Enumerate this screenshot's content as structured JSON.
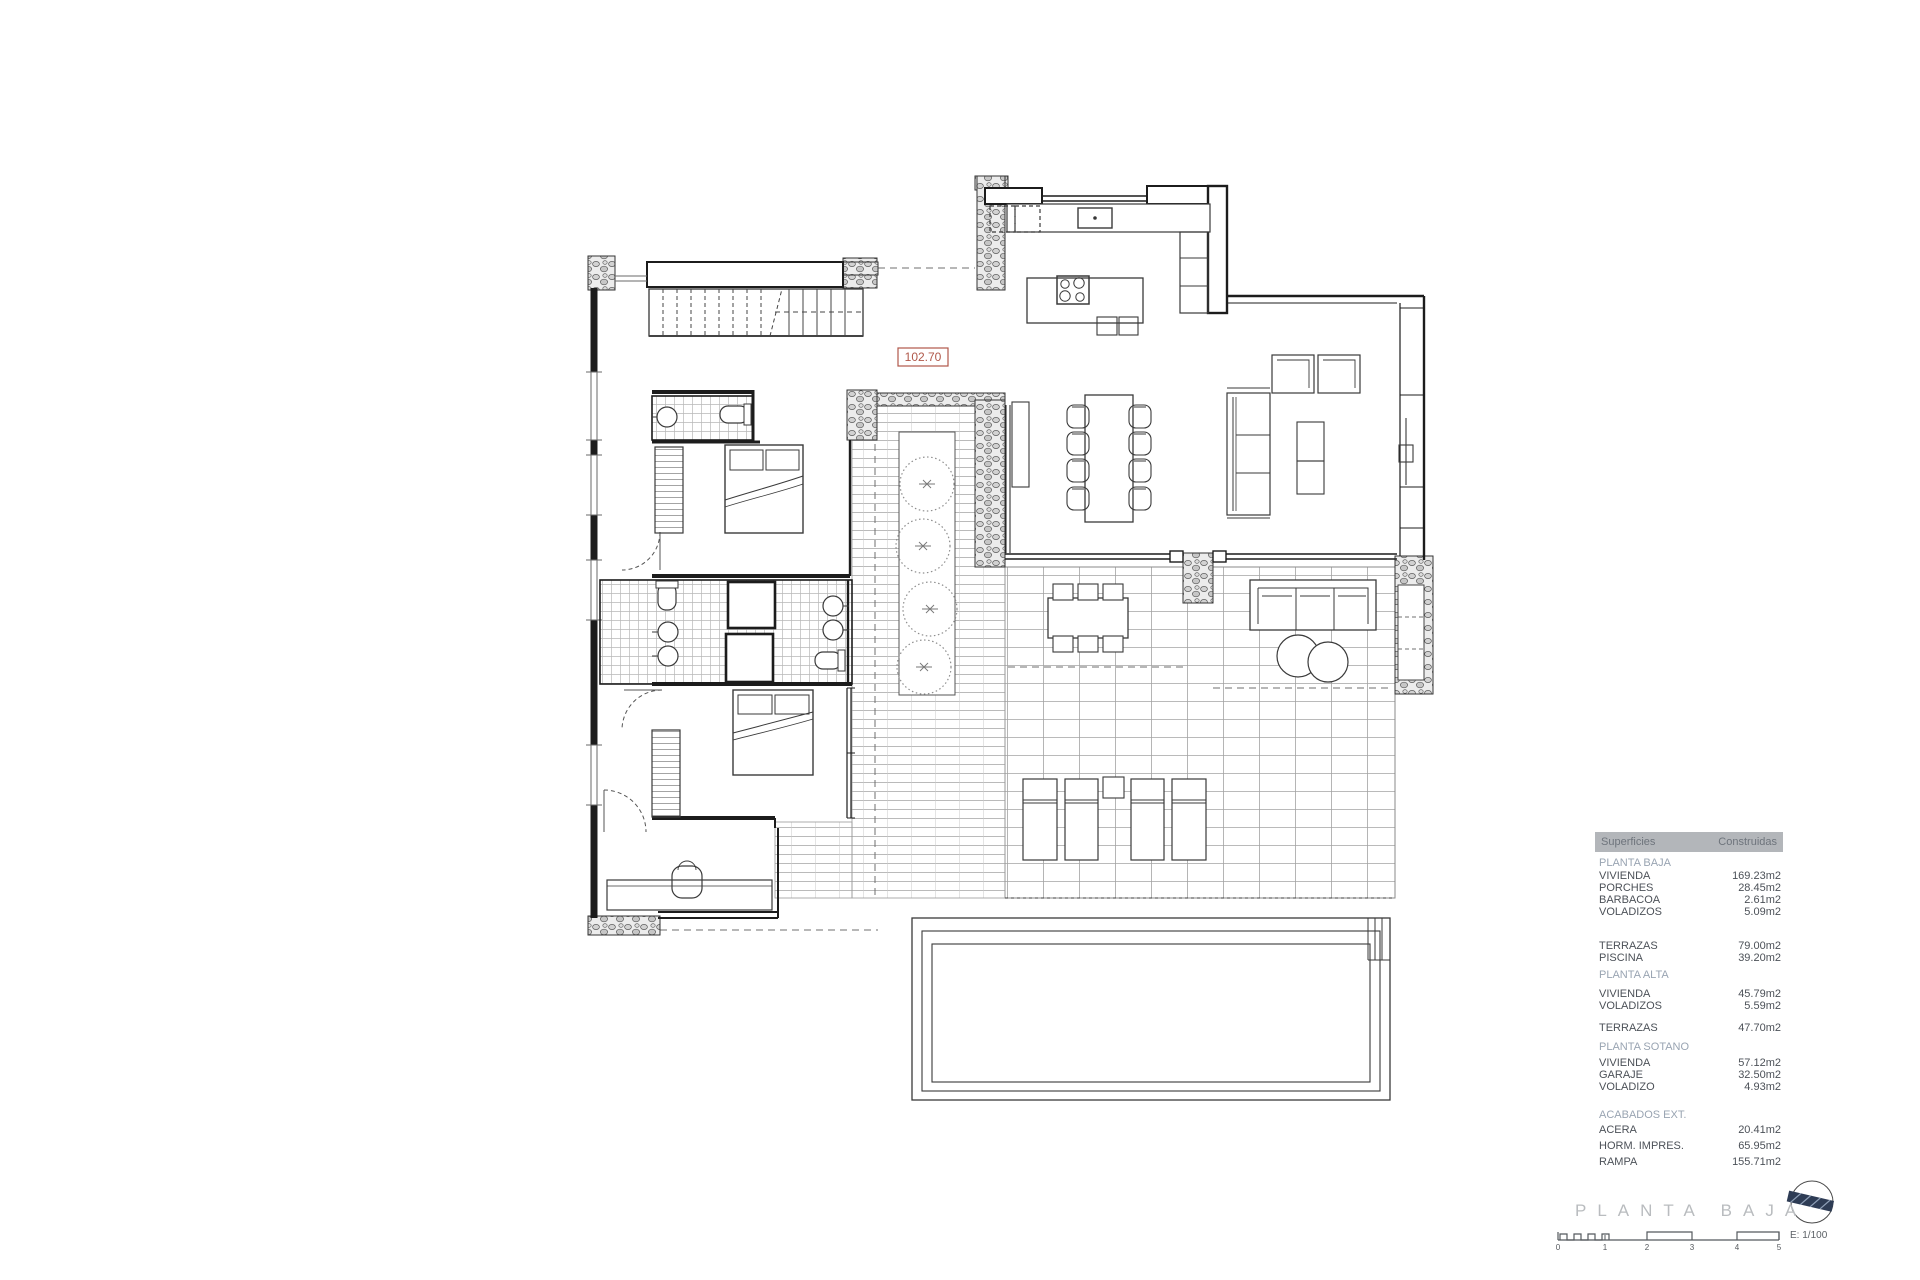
{
  "plan": {
    "red_label": "102.70",
    "title": "PLANTA BAJA",
    "scale_label": "E: 1/100",
    "scale_numbers": [
      "0",
      "1",
      "2",
      "3",
      "4",
      "5"
    ]
  },
  "table": {
    "header": {
      "col1": "Superficies",
      "col2": "Construidas"
    },
    "blocks": [
      {
        "header": "PLANTA BAJA",
        "rows": [
          {
            "label": "VIVIENDA",
            "value": "169.23m2"
          },
          {
            "label": "PORCHES",
            "value": "28.45m2"
          },
          {
            "label": "BARBACOA",
            "value": "2.61m2"
          },
          {
            "label": "VOLADIZOS",
            "value": "5.09m2"
          }
        ]
      },
      {
        "header": "",
        "rows": [
          {
            "label": "TERRAZAS",
            "value": "79.00m2"
          },
          {
            "label": "PISCINA",
            "value": "39.20m2"
          }
        ]
      },
      {
        "header": "PLANTA ALTA",
        "rows": [
          {
            "label": "VIVIENDA",
            "value": "45.79m2"
          },
          {
            "label": "VOLADIZOS",
            "value": "5.59m2"
          }
        ]
      },
      {
        "header": "",
        "rows": [
          {
            "label": "TERRAZAS",
            "value": "47.70m2"
          }
        ]
      },
      {
        "header": "PLANTA SOTANO",
        "rows": [
          {
            "label": "VIVIENDA",
            "value": "57.12m2"
          },
          {
            "label": "GARAJE",
            "value": "32.50m2"
          },
          {
            "label": "VOLADIZO",
            "value": "4.93m2"
          }
        ]
      },
      {
        "header": "ACABADOS EXT.",
        "rows": [
          {
            "label": "ACERA",
            "value": "20.41m2"
          },
          {
            "label": "HORM. IMPRES.",
            "value": "65.95m2"
          },
          {
            "label": "RAMPA",
            "value": "155.71m2"
          }
        ]
      }
    ]
  },
  "colors": {
    "red_label": "#b0584a",
    "table_header_bg": "#b3b6ba",
    "section_text": "#99a4b2",
    "north_arrow": "#2e3c55",
    "wall": "#1c1c1c",
    "tile_line": "#9a9a9a"
  }
}
